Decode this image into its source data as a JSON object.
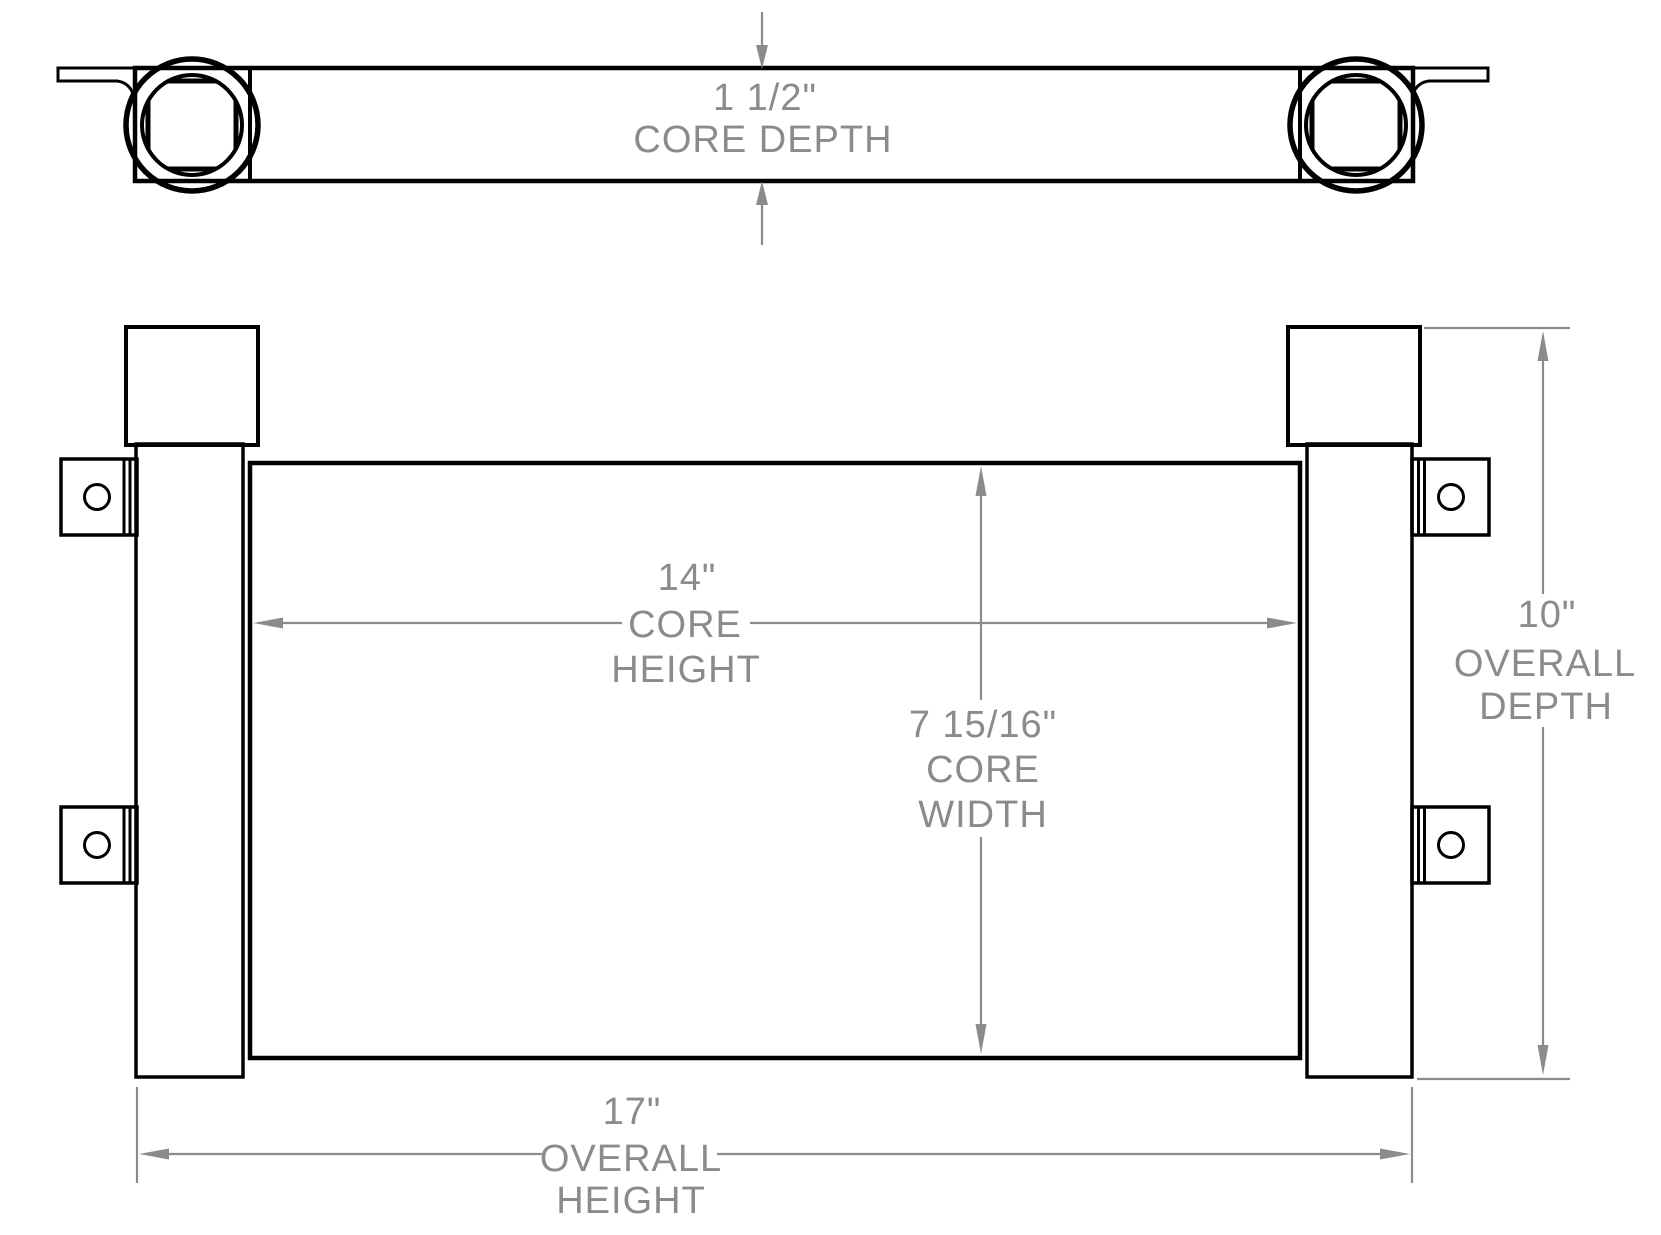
{
  "drawing": {
    "colors": {
      "linework": "#000000",
      "dimension": "#8b8b8b",
      "background": "#ffffff"
    },
    "dimensions": {
      "core_depth": {
        "value": "1 1/2\"",
        "label": "CORE DEPTH"
      },
      "core_height": {
        "value": "14\"",
        "label_line_1": "CORE",
        "label_line_2": "HEIGHT"
      },
      "core_width": {
        "value": "7 15/16\"",
        "label_line_1": "CORE",
        "label_line_2": "WIDTH"
      },
      "overall_depth": {
        "value": "10\"",
        "label_line_1": "OVERALL",
        "label_line_2": "DEPTH"
      },
      "overall_height": {
        "value": "17\"",
        "label_line_1": "OVERALL",
        "label_line_2": "HEIGHT"
      }
    }
  }
}
